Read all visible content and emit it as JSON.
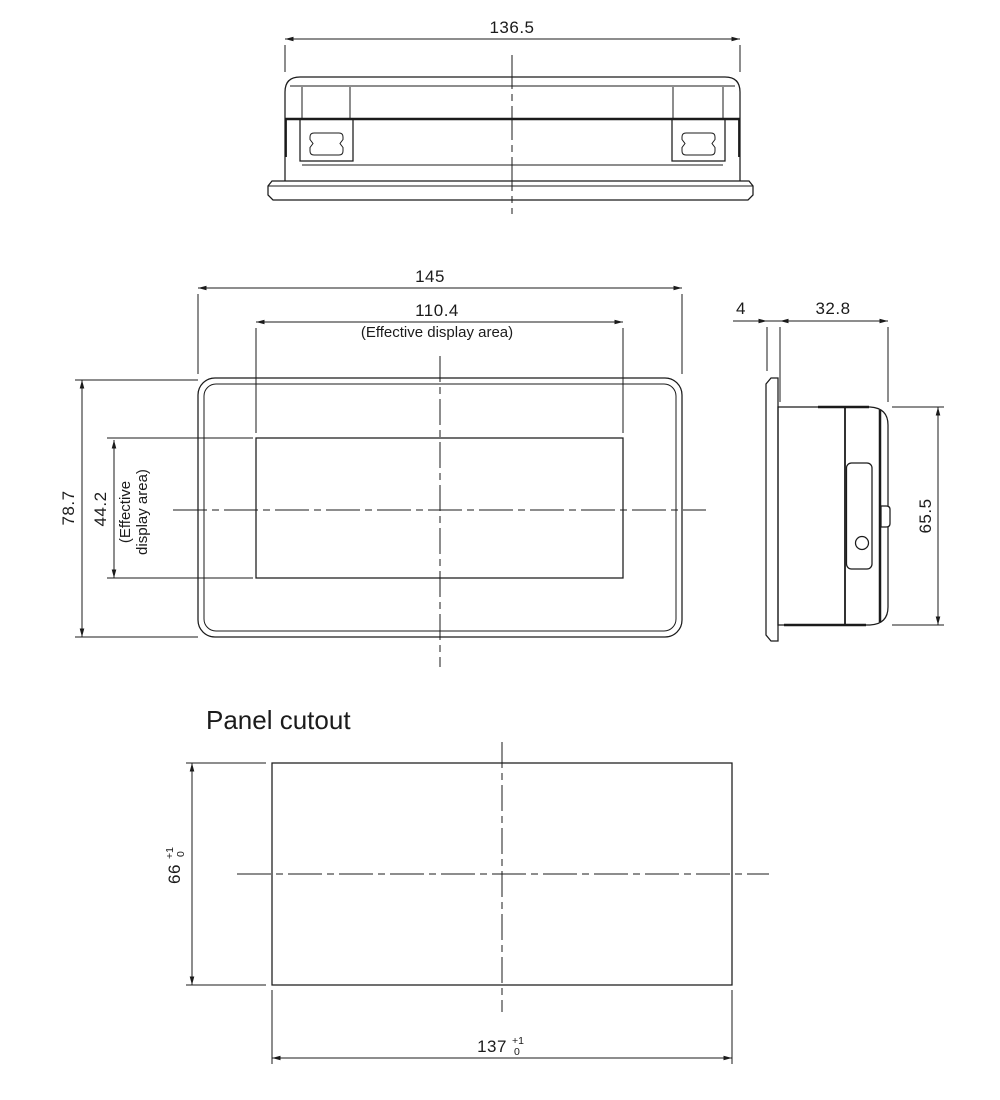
{
  "page": {
    "background": "#ffffff",
    "line_color": "#1b1b1b"
  },
  "views": {
    "top": {
      "dim_width": "136.5"
    },
    "front": {
      "dim_width": "145",
      "dim_display_width": "110.4",
      "display_width_note": "(Effective display area)",
      "dim_height": "78.7",
      "dim_display_height": "44.2",
      "display_height_note_line1": "(Effective",
      "display_height_note_line2": "display area)"
    },
    "side": {
      "dim_bezel_thickness": "4",
      "dim_depth": "32.8",
      "dim_height": "65.5"
    },
    "panel_cutout": {
      "title": "Panel cutout",
      "dim_height": "66",
      "dim_height_tol_upper": "+1",
      "dim_height_tol_lower": "0",
      "dim_width": "137",
      "dim_width_tol_upper": "+1",
      "dim_width_tol_lower": "0"
    }
  }
}
